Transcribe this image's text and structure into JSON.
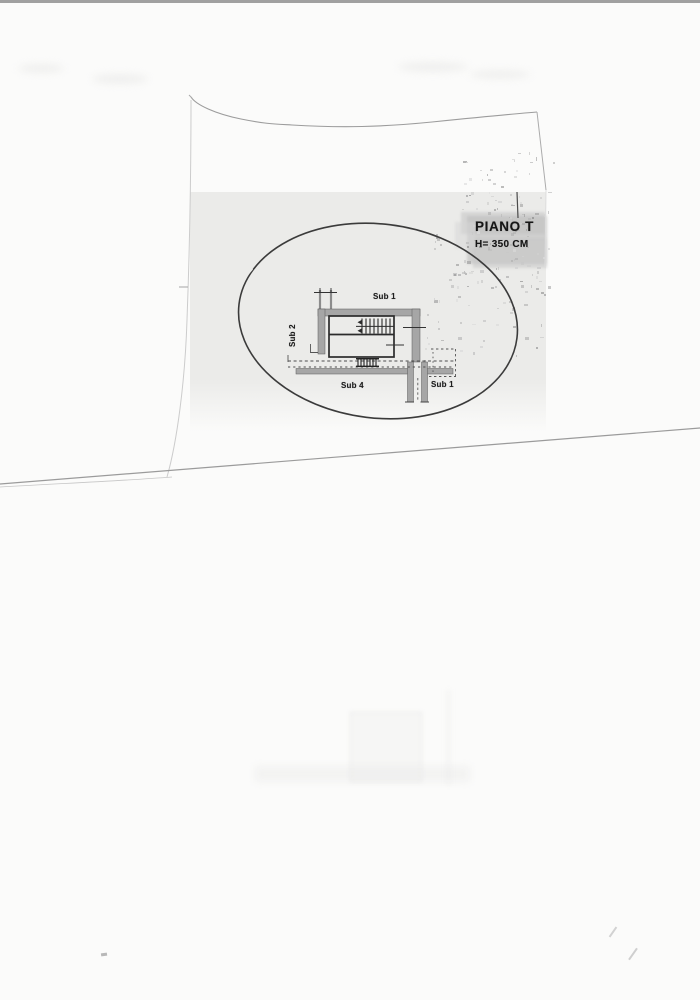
{
  "document": {
    "kind": "scanned-floor-plan-sheet",
    "header": {
      "title": "PIANO T",
      "height_note": "H= 350 CM"
    },
    "plan": {
      "labels": [
        {
          "id": "sub-1-upper",
          "text": "Sub 1"
        },
        {
          "id": "sub-2-left",
          "text": "Sub 2"
        },
        {
          "id": "sub-4-lower-left",
          "text": "Sub 4"
        },
        {
          "id": "sub-1-lower-right",
          "text": "Sub 1"
        }
      ]
    },
    "colors": {
      "paper": "#fbfbfa",
      "wash": "#ebebe9",
      "ink": "#1e1e1e",
      "wall": "#a6a6a6",
      "blotch": "#bcbcbc",
      "strip": "#8f8f8f"
    }
  }
}
